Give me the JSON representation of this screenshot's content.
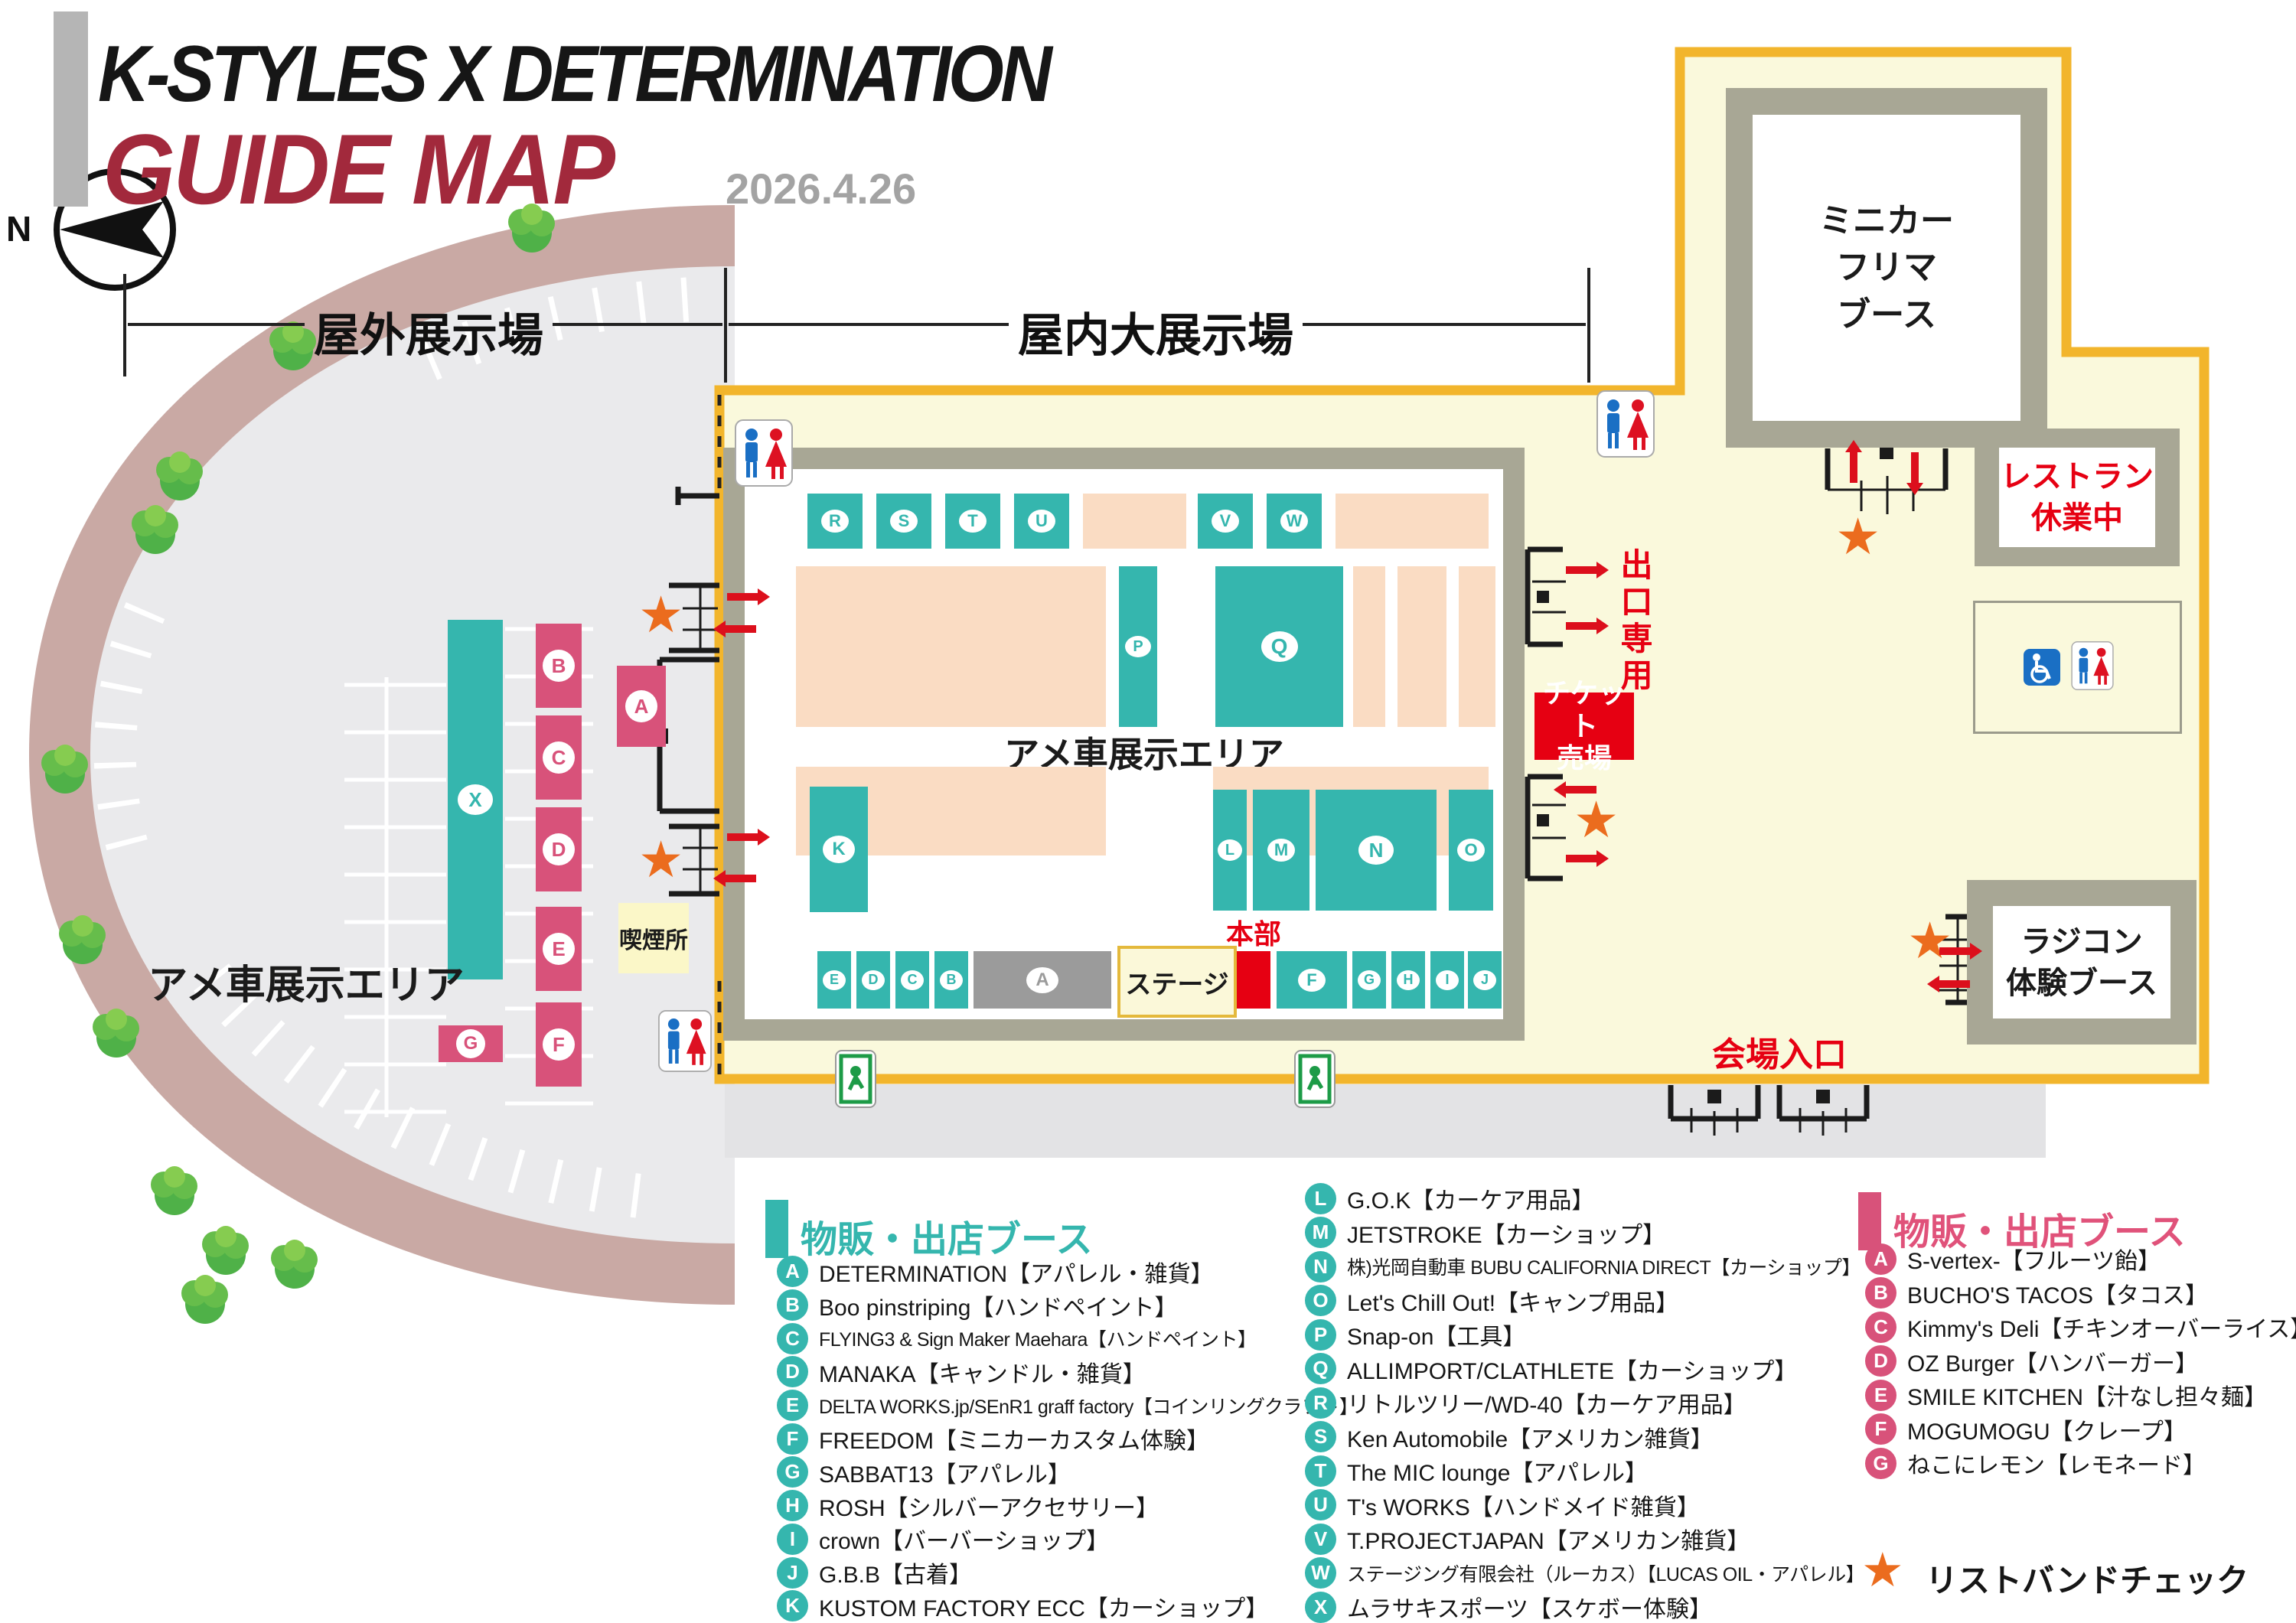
{
  "header": {
    "title_line1": "K-STYLES X DETERMINATION",
    "title_line2": "GUIDE MAP",
    "date": "2026.4.26"
  },
  "sections": {
    "outdoor": "屋外展示場",
    "indoor": "屋内大展示場"
  },
  "map": {
    "compass_n": "N",
    "star_char": "★",
    "outdoor_area_label": "アメ車展示エリア",
    "indoor_area_label": "アメ車展示エリア",
    "minicar_booth": "ミニカー\nフリマ\nブース",
    "restaurant": "レストラン\n休業中",
    "rc_booth": "ラジコン\n体験ブース",
    "exit_only": "出口専用",
    "ticket_office": "チケット\n売場",
    "hq": "本部",
    "stage": "ステージ",
    "smoking": "喫煙所",
    "entrance": "会場入口",
    "hall_booths": {
      "r": "R",
      "s": "S",
      "t": "T",
      "u": "U",
      "v": "V",
      "w": "W",
      "p": "P",
      "q": "Q",
      "k": "K",
      "l": "L",
      "m": "M",
      "n": "N",
      "o": "O",
      "e": "E",
      "d": "D",
      "c": "C",
      "b": "B",
      "a": "A",
      "f": "F",
      "g": "G",
      "h": "H",
      "i": "I",
      "j": "J"
    },
    "outdoor_booths": {
      "x": "X",
      "a": "A",
      "b": "B",
      "c": "C",
      "d": "D",
      "e": "E",
      "f": "F",
      "g": "G"
    }
  },
  "legend": {
    "teal": {
      "header": "物販・出店ブース",
      "col1": [
        {
          "letter": "A",
          "name": "DETERMINATION【アパレル・雑貨】"
        },
        {
          "letter": "B",
          "name": "Boo pinstriping【ハンドペイント】"
        },
        {
          "letter": "C",
          "name": "FLYING3 & Sign Maker Maehara【ハンドペイント】",
          "small": true
        },
        {
          "letter": "D",
          "name": "MANAKA【キャンドル・雑貨】"
        },
        {
          "letter": "E",
          "name": "DELTA WORKS.jp/SEnR1 graff factory【コインリングクラフト】",
          "small": true
        },
        {
          "letter": "F",
          "name": "FREEDOM【ミニカーカスタム体験】"
        },
        {
          "letter": "G",
          "name": "SABBAT13【アパレル】"
        },
        {
          "letter": "H",
          "name": "ROSH【シルバーアクセサリー】"
        },
        {
          "letter": "I",
          "name": "crown【バーバーショップ】"
        },
        {
          "letter": "J",
          "name": "G.B.B【古着】"
        },
        {
          "letter": "K",
          "name": "KUSTOM FACTORY ECC【カーショップ】"
        }
      ],
      "col2": [
        {
          "letter": "L",
          "name": "G.O.K【カーケア用品】"
        },
        {
          "letter": "M",
          "name": "JETSTROKE【カーショップ】"
        },
        {
          "letter": "N",
          "name": "株)光岡自動車 BUBU CALIFORNIA DIRECT【カーショップ】",
          "small": true
        },
        {
          "letter": "O",
          "name": "Let's Chill Out!【キャンプ用品】"
        },
        {
          "letter": "P",
          "name": "Snap-on【工具】"
        },
        {
          "letter": "Q",
          "name": "ALLIMPORT/CLATHLETE【カーショップ】"
        },
        {
          "letter": "R",
          "name": "リトルツリー/WD-40【カーケア用品】"
        },
        {
          "letter": "S",
          "name": "Ken Automobile【アメリカン雑貨】"
        },
        {
          "letter": "T",
          "name": "The MIC lounge【アパレル】"
        },
        {
          "letter": "U",
          "name": "T's WORKS【ハンドメイド雑貨】"
        },
        {
          "letter": "V",
          "name": "T.PROJECTJAPAN【アメリカン雑貨】"
        },
        {
          "letter": "W",
          "name": "ステージング有限会社（ルーカス）【LUCAS OIL・アパレル】",
          "small": true
        },
        {
          "letter": "X",
          "name": "ムラサキスポーツ【スケボー体験】"
        }
      ]
    },
    "pink": {
      "header": "物販・出店ブース",
      "items": [
        {
          "letter": "A",
          "name": "S-vertex-【フルーツ飴】"
        },
        {
          "letter": "B",
          "name": "BUCHO'S TACOS【タコス】"
        },
        {
          "letter": "C",
          "name": "Kimmy's Deli【チキンオーバーライス】"
        },
        {
          "letter": "D",
          "name": "OZ Burger【ハンバーガー】"
        },
        {
          "letter": "E",
          "name": "SMILE KITCHEN【汁なし担々麺】"
        },
        {
          "letter": "F",
          "name": "MOGUMOGU【クレープ】"
        },
        {
          "letter": "G",
          "name": "ねこにレモン【レモネード】"
        }
      ]
    },
    "star_note": "リストバンドチェック"
  },
  "colors": {
    "teal": "#35b6ae",
    "pink": "#d8527a",
    "peach": "#fadcc3",
    "venue_fill": "#faf9dc",
    "venue_border": "#f2b52c",
    "wall": "#a8a795",
    "red": "#e60012",
    "star": "#eb6c1e",
    "ring": "#c9a9a4",
    "parking": "#eaeaec",
    "title_red": "#a2293c"
  }
}
